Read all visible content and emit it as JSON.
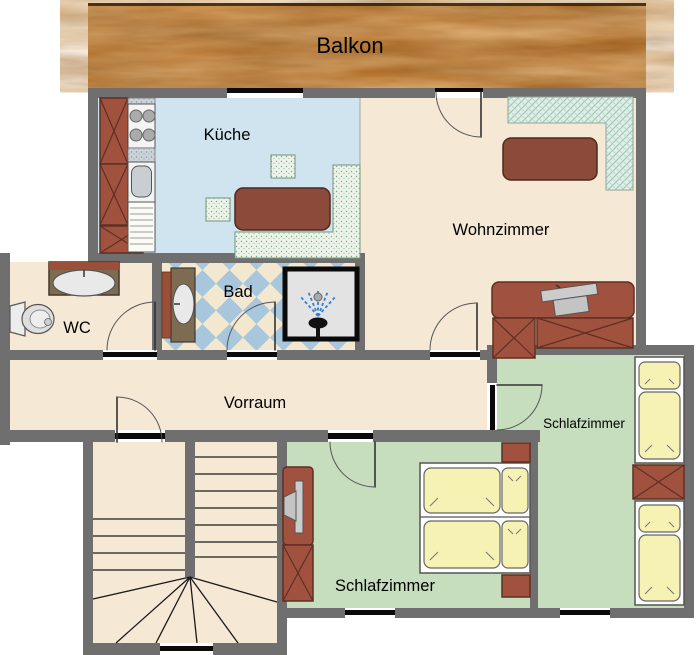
{
  "floorplan": {
    "balcony_label": "Balkon",
    "rooms": {
      "kitchen": "Küche",
      "living_room": "Wohnzimmer",
      "bathroom": "Bad",
      "wc": "WC",
      "hallway": "Vorraum",
      "bedroom_right": "Schlafzimmer",
      "bedroom_bottom": "Schlafzimmer"
    },
    "colors": {
      "wall": "#6F6F6F",
      "floor_cream": "#F5E8D5",
      "floor_kitchen": "#CFE4EE",
      "floor_bedroom": "#C6DEBD",
      "tile_blue": "#A8C6DC",
      "shower_gray": "#E3E3E3",
      "furniture_brown": "#A0523F",
      "table_brown": "#8C4A3A",
      "bed_yellow": "#F6F2B4",
      "balcony_wood": "#B06A22",
      "spray_blue": "#2E7FD6"
    }
  }
}
